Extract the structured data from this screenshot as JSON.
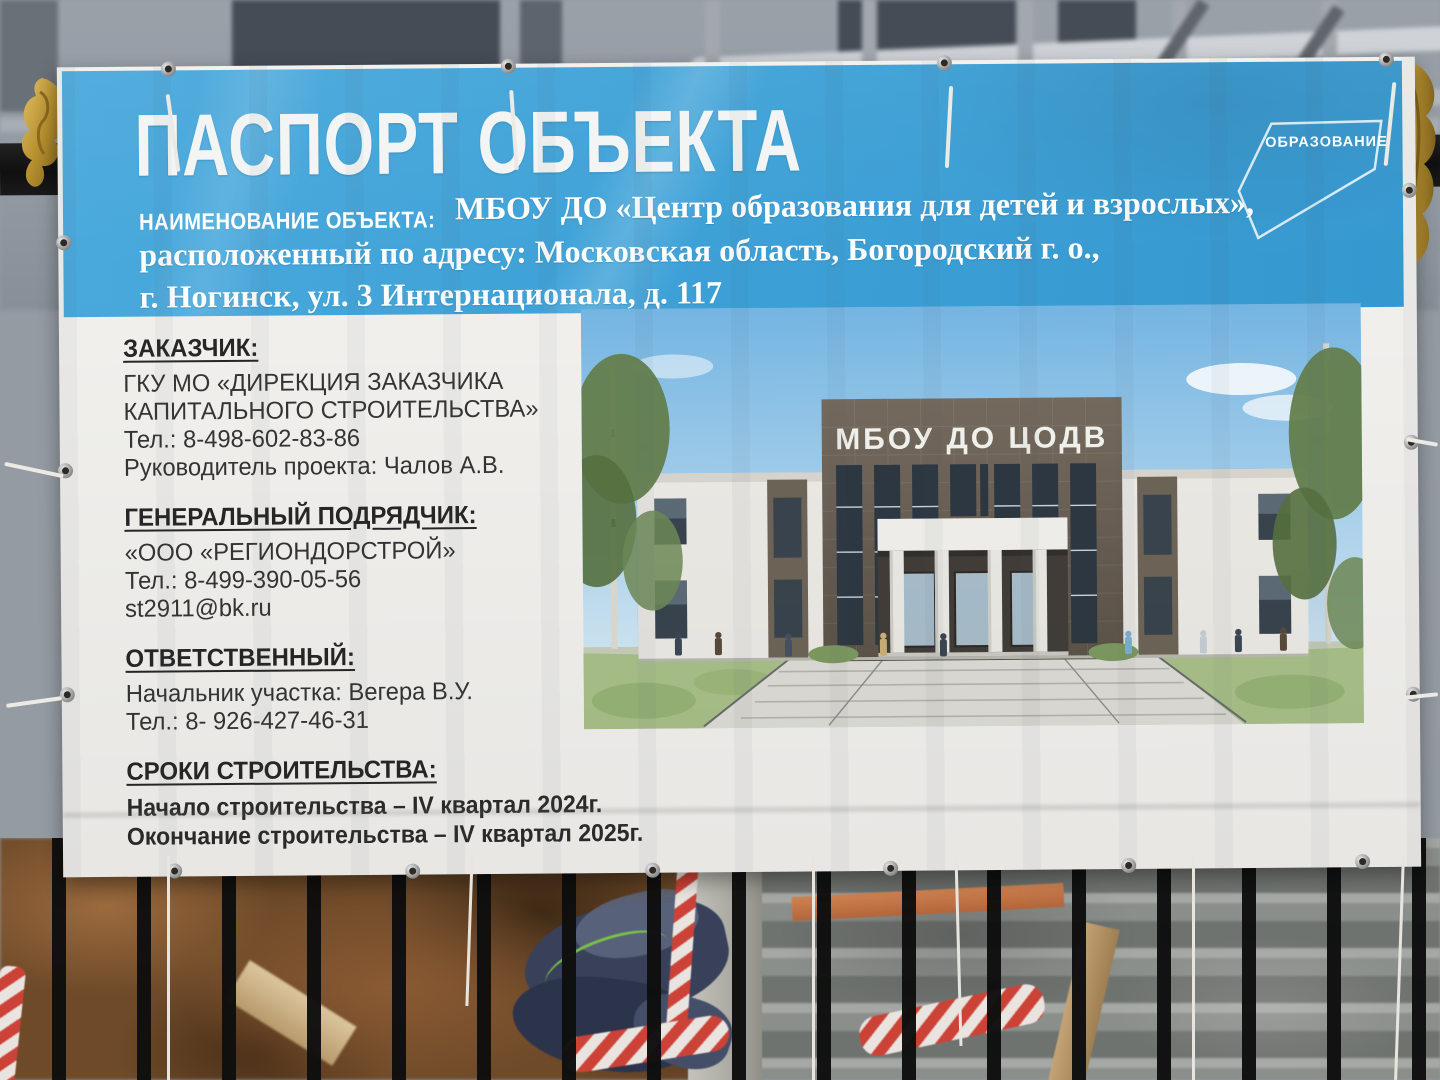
{
  "banner": {
    "title": "ПАСПОРТ ОБЪЕКТА",
    "object_name_label": "НАИМЕНОВАНИЕ ОБЪЕКТА:",
    "object_name": "МБОУ ДО «Центр образования для детей и взрослых»,",
    "address_line_1": "расположенный по адресу: Московская область, Богородский г. о.,",
    "address_line_2": "г. Ногинск, ул. 3 Интернационала, д. 117",
    "logo_label": "ОБРАЗОВАНИЕ",
    "sections": [
      {
        "title": "ЗАКАЗЧИК:",
        "lines": [
          "ГКУ МО «ДИРЕКЦИЯ ЗАКАЗЧИКА",
          "КАПИТАЛЬНОГО СТРОИТЕЛЬСТВА»",
          "Тел.: 8-498-602-83-86",
          "Руководитель проекта: Чалов А.В."
        ]
      },
      {
        "title": "ГЕНЕРАЛЬНЫЙ ПОДРЯДЧИК:",
        "lines": [
          "«ООО «РЕГИОНДОРСТРОЙ»",
          "Тел.: 8-499-390-05-56",
          "st2911@bk.ru"
        ]
      },
      {
        "title": "ОТВЕТСТВЕННЫЙ:",
        "lines": [
          "Начальник участка: Вегера В.У.",
          "Тел.: 8- 926-427-46-31"
        ]
      },
      {
        "title": "СРОКИ СТРОИТЕЛЬСТВА:",
        "lines": [
          "Начало строительства – IV квартал 2024г.",
          "Окончание строительства – IV квартал 2025г."
        ]
      }
    ],
    "render": {
      "building_sign": "МБОУ ДО ЦОДВ"
    },
    "colors": {
      "header_blue": "#3da1d7",
      "body_white": "#f1f0ed",
      "text_dark": "#303030",
      "text_white": "#ffffff",
      "gold": "#c59a3a",
      "tape_red": "#cd4237"
    }
  }
}
